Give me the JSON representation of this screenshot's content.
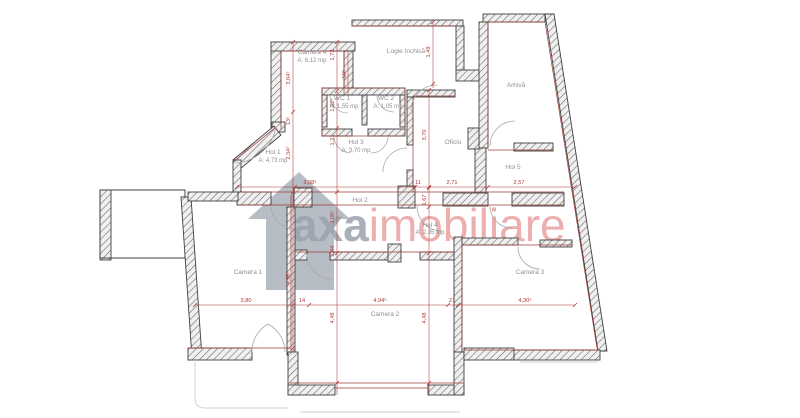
{
  "colors": {
    "dim-red": "#b03535",
    "wall-red": "#9c3a32",
    "wall-dark": "#3f3f3f",
    "label-gray": "#8f8f8f",
    "brand-gray": "#9aa4ae",
    "brand-pink": "#e69090"
  },
  "watermark": {
    "brand_left": "axa",
    "brand_right": "imobiliare",
    "icon": "house-icon"
  },
  "rooms": {
    "camera4": {
      "label": "Camera 4",
      "area": "A: 6,12 mp"
    },
    "logie": {
      "label": "Logie închisă"
    },
    "arhiva": {
      "label": "Arhivă"
    },
    "wc1": {
      "label": "WC 1",
      "area": "A: 1,55 mp"
    },
    "wc2": {
      "label": "WC 2",
      "area": "A: 1,05 mp"
    },
    "hol1": {
      "label": "Hol 1",
      "area": "A: 4,73 mp"
    },
    "hol3": {
      "label": "Hol 3",
      "area": "A: 3,70 mp"
    },
    "oficiu": {
      "label": "Oficiu"
    },
    "hol5": {
      "label": "Hol 5"
    },
    "hol2": {
      "label": "Hol 2"
    },
    "hol4": {
      "label": "Hol 4",
      "area": "A: 2,35 mp"
    },
    "camera1": {
      "label": "Camera 1"
    },
    "camera2": {
      "label": "Camera 2"
    },
    "camera3": {
      "label": "Camera 3"
    }
  },
  "dims": {
    "v304": "3,04⁵",
    "v172": "1,72",
    "v149": "1,49",
    "v50": "50⁵",
    "v122": "1,22⁵",
    "v121": "1,21",
    "v13": "13⁵",
    "v234": "2,34⁵",
    "v370": "3,70",
    "h308": "3,08⁵",
    "h11": "11",
    "h271": "2,71",
    "h257": "2,57",
    "v306": "3,06⁵",
    "v167": "1,67",
    "v244": "2,44",
    "v496": "4,96⁵",
    "v448a": "4,48",
    "v448b": "4,48",
    "h380": "3,80",
    "h14": "14",
    "h494": "4,94⁵",
    "h21": "21",
    "h430": "4,30⁵"
  }
}
